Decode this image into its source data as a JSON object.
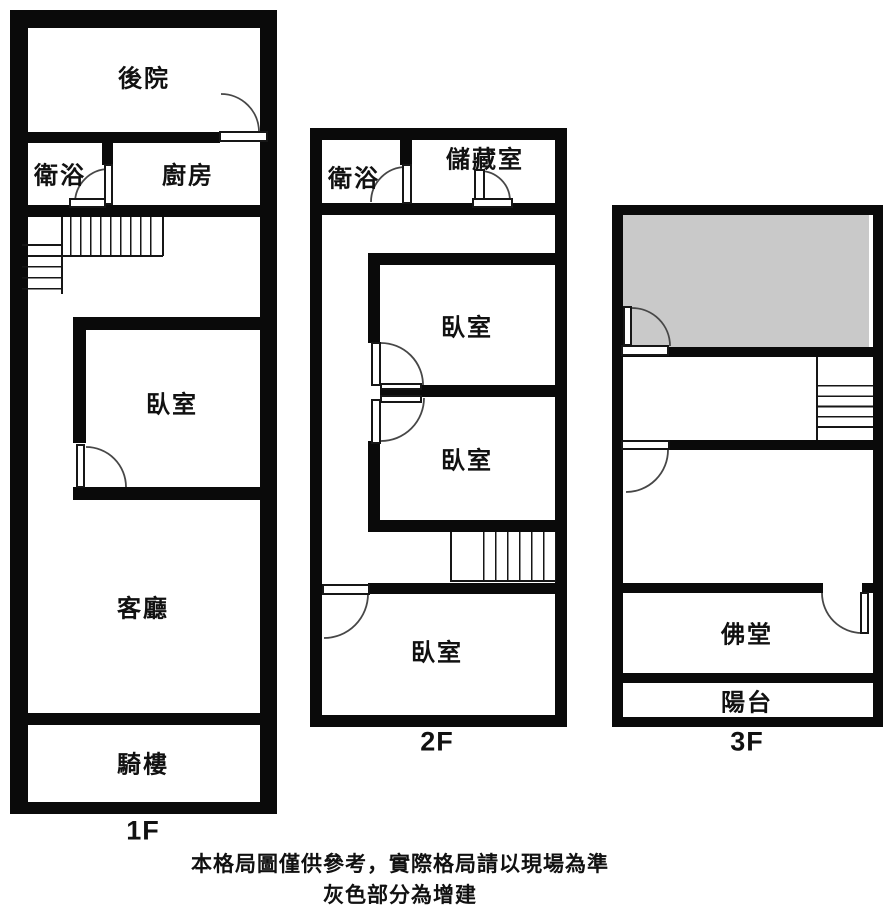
{
  "colors": {
    "wall": "#0a0a0a",
    "addition_fill": "#c9c9c9",
    "background": "#ffffff"
  },
  "floors": [
    {
      "name": "1F",
      "rooms": {
        "backyard": "後院",
        "bathroom": "衛浴",
        "kitchen": "廚房",
        "bedroom": "臥室",
        "living_room": "客廳",
        "arcade": "騎樓"
      }
    },
    {
      "name": "2F",
      "rooms": {
        "bathroom": "衛浴",
        "storage": "儲藏室",
        "bedroom_1": "臥室",
        "bedroom_2": "臥室",
        "bedroom_3": "臥室"
      }
    },
    {
      "name": "3F",
      "rooms": {
        "buddhist_hall": "佛堂",
        "balcony": "陽台"
      }
    }
  ],
  "caption": {
    "line1": "本格局圖僅供參考，實際格局請以現場為準",
    "line2": "灰色部分為增建"
  }
}
